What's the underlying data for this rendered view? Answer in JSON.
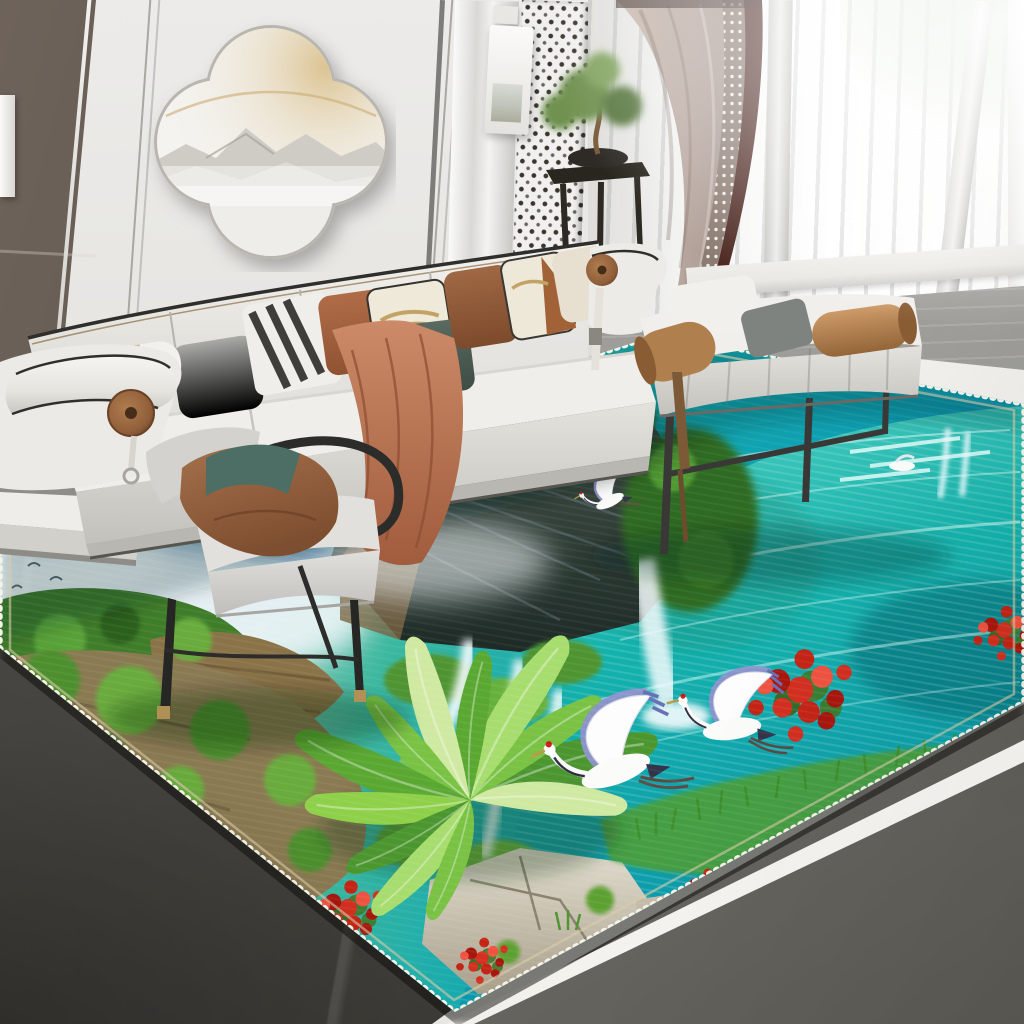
{
  "meta": {
    "image_type": "product-photo",
    "description": "Modern living room staging a 3D landscape-print area rug: misty mountains, waterfalls, turquoise lake, red-crowned cranes, banana plant and red roses; white modular sofa, accent chair, daybed bench, bonsai plant stand, quatrefoil wall art, sheer sunlit windows, gray stone floor"
  },
  "palette": {
    "wall_light": "#e7e6e3",
    "wall_mid": "#d8d6d2",
    "wall_shadow": "#bdbab5",
    "wall_dark": "#6e635a",
    "wall_dark_deep": "#4c443d",
    "trim_line": "#a9a7a2",
    "pillar_light": "#f4f3f1",
    "lattice_ink": "#3a352f",
    "art_white": "#f4f3f0",
    "art_rim": "#b9b6b0",
    "art_mountain": "#cfccc6",
    "art_glow": "#d9c193",
    "curtain_taupe": "#c0b0a6",
    "curtain_deep": "#978880",
    "curtain_maroon": "#4e2a24",
    "sheer_white": "#f7f7f6",
    "window_green": "#b8ceaa",
    "sill_white": "#e9e8e4",
    "terrace_gray": "#a8a7a3",
    "terrace_deep": "#8f8e8a",
    "ledge_white": "#efeee9",
    "floor_sliver": "#8e8d89",
    "floor_dark": "#53514c",
    "floor_dark2": "#6e6c66",
    "floor_trim": "#e9e7e1",
    "sofa_white": "#eeece8",
    "sofa_front": "#d6d4cf",
    "sofa_deep": "#bcbab5",
    "piping": "#2f2e2b",
    "wood_disc": "#8f5f3a",
    "wood_core": "#462c1a",
    "pillow_gray": "#9c9c99",
    "pillow_stripe": "#403e3a",
    "pillow_rust": "#ad6a47",
    "pillow_gold_base": "#efe9da",
    "pillow_gold": "#c3a365",
    "pillow_green": "#4c5c52",
    "pillow_brown": "#96603e",
    "pillow_cream": "#e7e0d0",
    "throw": "#c5805f",
    "throw_deep": "#a05c3d",
    "chair_shell": "#d9d7d3",
    "chair_frame": "#2c2c2a",
    "brass": "#b09055",
    "bench_cushion": "#efede9",
    "caramel": "#c08a58",
    "caramel_deep": "#936538",
    "leg_dark": "#3a3836",
    "stand_dark": "#29251f",
    "bonsai": "#6f9150",
    "rug_mist": "#bdd6e6",
    "rug_mountain": "#6d97b8",
    "rug_cliff": "#22302b",
    "rug_cliff_lite": "#47564c",
    "rug_forest": "#2f6b22",
    "moss": "#4e8f2e",
    "moss_bright": "#69ab3d",
    "leaf": "#5aa832",
    "leaf_light": "#a7dc6e",
    "falls": "#f4fbfd",
    "lake": "#14b2ac",
    "lake_deep": "#0a93ab",
    "lake_light": "#5fd6c6",
    "boulder": "#d6d0c0",
    "boulder_deep": "#a89f8a",
    "rock_tan": "#9c8457",
    "flower_red": "#d33020",
    "flower_deep": "#a8170e",
    "crane_white": "#fbfbfa",
    "crane_wing": "#8e92cc",
    "crane_red": "#d01818",
    "stitch": "#f5f2e8"
  },
  "scene": {
    "room": {
      "wall_art": {
        "shape": "quatrefoil",
        "motif": "misty-mountain relief with warm backlight"
      },
      "window": {
        "treatment": [
          "sheer-white-curtains",
          "taupe-drape-with-maroon-patterned-trim"
        ],
        "light": "bright daylight, greenery outside"
      },
      "decor": [
        "black-plant-stand-with-bonsai",
        "lattice-screen-panel",
        "wall-mounted-light-box",
        "floating-side-shelf"
      ]
    },
    "furniture": {
      "sofa": {
        "color": "white",
        "accents": [
          "black piping",
          "cylindrical arm bolster with wood disc"
        ],
        "pillows": [
          "white-striped-bolster",
          "gray",
          "black-white-striped",
          "rust",
          "white-gold-art",
          "dark-green",
          "brown-leather",
          "white-gold-art-2",
          "cream"
        ],
        "throw": "terracotta"
      },
      "accent_chair": {
        "color": "light-gray",
        "frame": "black metal with brass feet",
        "pillow": "terracotta with teal band"
      },
      "daybed_bench": {
        "color": "white",
        "bolsters": "caramel leather",
        "pillows": [
          "white",
          "gray"
        ],
        "legs": "thin black metal"
      }
    },
    "rug": {
      "type": "3D landscape print area rug",
      "motifs": [
        "misty blue mountains",
        "dark karst cliff",
        "tiered waterfalls",
        "turquoise rippled lake",
        "two flying red-crowned cranes",
        "banana plant",
        "red rose bushes",
        "white boulders",
        "moss-covered rocks",
        "small white birds"
      ],
      "border": "white serged stitch edge"
    },
    "floor": {
      "material": "gray stone/concrete",
      "details": [
        "white diagonal trim strip",
        "dark marble veining bottom-left"
      ]
    }
  }
}
